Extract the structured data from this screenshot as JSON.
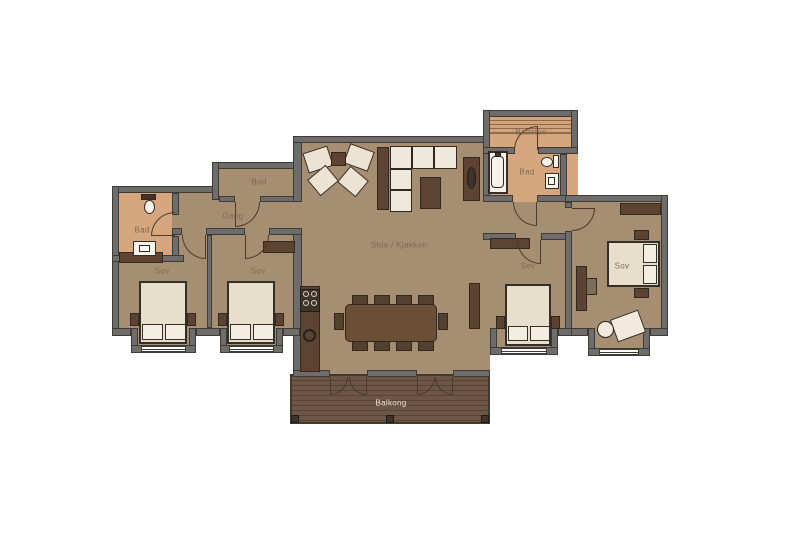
{
  "floorplan": {
    "labels": {
      "bod": "Bod",
      "gang": "Gang",
      "bad_left": "Bad",
      "sov_left_1": "Sov",
      "sov_left_2": "Sov",
      "stue_kjokken": "Stue / Kjøkken",
      "badstue": "Badstue",
      "bad_right": "Bad",
      "sov_mid": "Sov",
      "sov_right": "Sov",
      "balkong": "Balkong"
    },
    "colors": {
      "background": "#ffffff",
      "wall_fill": "#6e6d6b",
      "wall_outline": "#3e3a34",
      "floor_main": "#a68e72",
      "floor_bath": "#d6a77e",
      "balcony_wood": "#6d5645",
      "furniture_dark": "#5d4331",
      "furniture_cream": "#ece3d2",
      "bed_linen": "#e7decc",
      "pillow": "#f4eee1",
      "label_text": "#7b6b54",
      "balcony_label_text": "#ece3d0"
    }
  }
}
